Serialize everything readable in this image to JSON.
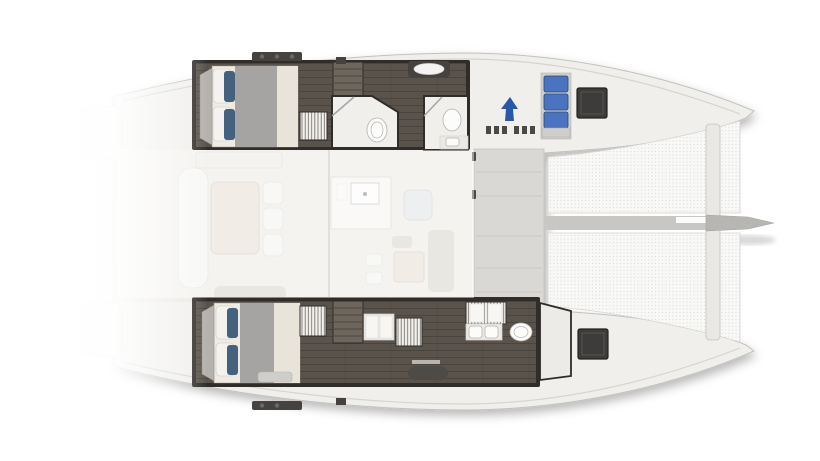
{
  "diagram": {
    "type": "yacht-floorplan",
    "subject": "catamaran deck and interior, top view",
    "orientation": "bow-right",
    "colors": {
      "background": "#ffffff",
      "deck": "#f0efec",
      "deck_stroke": "#c2c1be",
      "deck_inner_line": "#d5d4d1",
      "transom": "#f2f1ee",
      "platform": "#d9d8d4",
      "platform_seam": "#c3c2bf",
      "walkway": "#f3f2ef",
      "net_bg": "#f8f8f7",
      "net_dot": "#d4d3d1",
      "spine": "#c8c7c4",
      "spine_white": "#fbfbfa",
      "crossbeam": "#e9e8e5",
      "bowsprit": "#b7b6b3",
      "wall_dark": "#2f2c29",
      "wood": "#5a534b",
      "plank": "#453f39",
      "stair": "#6e665d",
      "stair_tread": "#4c463f",
      "mattress": "#efebe2",
      "duvet": "#a5a4a2",
      "sheet": "#e9e4da",
      "pillow_white": "#f4f2ee",
      "pillow_blue": "#44617e",
      "headboard": "#b5b2ae",
      "louver": "#f2f1ee",
      "louver_line": "#6b655e",
      "bath_floor": "#f0efec",
      "porcelain": "#fcfcfb",
      "porcelain_line": "#b6b3af",
      "glass": "#9fa6ab",
      "seat_blue": "#4a73c0",
      "seat_blue_line": "#24457e",
      "seat_base": "#cfcecb",
      "hatch": "#3d3c3a",
      "hatch_line": "#232220",
      "hatch_inner": "#56544f",
      "arrow": "#2b57a8",
      "roof_dark": "#45423f",
      "liferaft_oval": "#f4f3f1",
      "island": "#f6f5f2",
      "island_line": "#d6d3cd",
      "table": "#e5dfd2",
      "table_line": "#cfc8b8",
      "sofa_pale": "#dfe2e6",
      "sofa_taupe": "#d8d3c9",
      "seat_white": "#f3f2ef",
      "bench_dark": "#4e4a45",
      "counter": "#ece9e3",
      "cleat": "#4b4947",
      "locker": "#edebe8",
      "saloon_floor": "#ece9e3",
      "ghost": "#ffffff"
    },
    "structure": {
      "bow_direction": "right",
      "hulls": [
        {
          "side": "port",
          "position": "top",
          "features": [
            "aft double bed with blue and white pillows",
            "companionway stairs",
            "louvered locker",
            "midship bathroom with toilet and shower door",
            "forward bathroom with toilet and sink",
            "forward blue bench seat (3 cushions)",
            "dark deck hatch"
          ]
        },
        {
          "side": "starboard",
          "position": "bottom",
          "features": [
            "aft double bed with blue and white pillows",
            "foot-of-bed bench",
            "companionway stairs",
            "two louvered lockers",
            "vanity counters",
            "bathroom with twin sinks and toilet",
            "forward locker compartment",
            "dark deck hatch",
            "corridor settee"
          ]
        }
      ],
      "bridgedeck": [
        "ghosted aft cockpit with table, chairs and bench",
        "ghosted saloon with galley island, sink, sofa and table",
        "mast line",
        "forward cockpit platform with seam panels",
        "blue walkway arrow"
      ],
      "foredeck": [
        "twin trampoline nets with dot mesh",
        "central anchor spine",
        "forward crossbeam",
        "bowsprit extending to starboard of frame"
      ],
      "roof_fittings": [
        "dark winch bar aft port",
        "liferaft canister with white oval",
        "dark winch bar aft starboard"
      ]
    }
  }
}
